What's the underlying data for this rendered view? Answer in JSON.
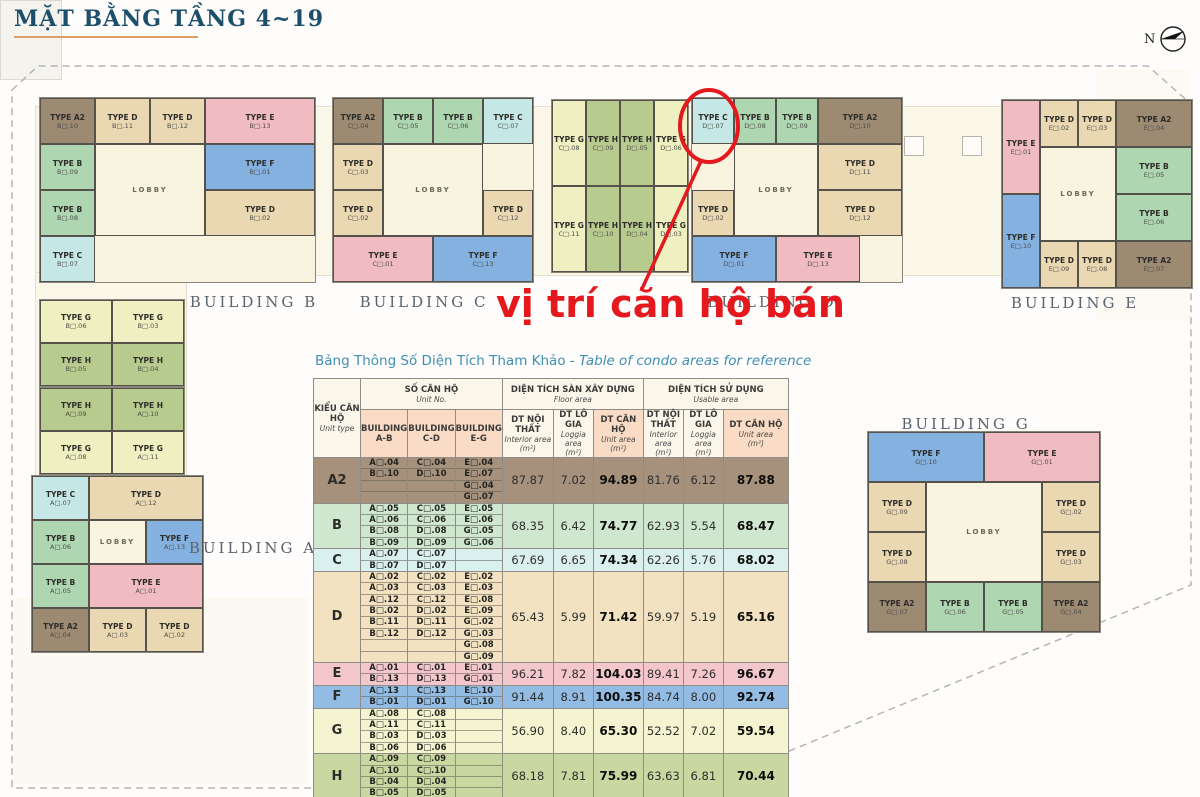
{
  "page": {
    "title": "MẶT BẰNG TẦNG 4~19",
    "north_label": "N",
    "annotation": {
      "text": "vị trí căn hộ bán",
      "color": "#e5191d",
      "highlighted_unit": "TYPE C D□.07"
    }
  },
  "type_colors": {
    "A2": "#9c8a72",
    "B": "#aed6b0",
    "C": "#c5e8e6",
    "D": "#ead8b3",
    "E": "#f0bcc2",
    "F": "#84b1e0",
    "G": "#eff0c2",
    "H": "#b7cb8e",
    "LOBBY": "#f8f4df"
  },
  "plan": {
    "building_labels": [
      "BUILDING B",
      "BUILDING C",
      "BUILDING D",
      "BUILDING E",
      "BUILDING A",
      "BUILDING G"
    ],
    "clusters": [
      {
        "id": "b-main",
        "units": [
          {
            "t": "A2",
            "label": "TYPE A2",
            "no": "B□.10"
          },
          {
            "t": "D",
            "label": "TYPE D",
            "no": "B□.11"
          },
          {
            "t": "D",
            "label": "TYPE D",
            "no": "B□.12"
          },
          {
            "t": "E",
            "label": "TYPE E",
            "no": "B□.13"
          },
          {
            "t": "B",
            "label": "TYPE B",
            "no": "B□.09"
          },
          {
            "t": "LOBBY",
            "label": "LOBBY",
            "no": ""
          },
          {
            "t": "F",
            "label": "TYPE F",
            "no": "B□.01"
          },
          {
            "t": "B",
            "label": "TYPE B",
            "no": "B□.08"
          },
          {
            "t": "D",
            "label": "TYPE D",
            "no": "B□.02"
          },
          {
            "t": "C",
            "label": "TYPE C",
            "no": "B□.07"
          }
        ]
      },
      {
        "id": "c-main",
        "units": [
          {
            "t": "A2",
            "label": "TYPE A2",
            "no": "C□.04"
          },
          {
            "t": "B",
            "label": "TYPE B",
            "no": "C□.05"
          },
          {
            "t": "B",
            "label": "TYPE B",
            "no": "C□.06"
          },
          {
            "t": "C",
            "label": "TYPE C",
            "no": "C□.07"
          },
          {
            "t": "D",
            "label": "TYPE D",
            "no": "C□.03"
          },
          {
            "t": "LOBBY",
            "label": "LOBBY",
            "no": ""
          },
          {
            "t": "D",
            "label": "TYPE D",
            "no": "C□.02"
          },
          {
            "t": "D",
            "label": "TYPE D",
            "no": "C□.12"
          },
          {
            "t": "E",
            "label": "TYPE E",
            "no": "C□.01"
          },
          {
            "t": "F",
            "label": "TYPE F",
            "no": "C□.13"
          }
        ]
      },
      {
        "id": "mid-gh",
        "units": [
          {
            "t": "G",
            "label": "TYPE G",
            "no": "C□.08"
          },
          {
            "t": "H",
            "label": "TYPE H",
            "no": "C□.09"
          },
          {
            "t": "H",
            "label": "TYPE H",
            "no": "D□.05"
          },
          {
            "t": "G",
            "label": "TYPE G",
            "no": "D□.06"
          },
          {
            "t": "G",
            "label": "TYPE G",
            "no": "C□.11"
          },
          {
            "t": "H",
            "label": "TYPE H",
            "no": "C□.10"
          },
          {
            "t": "H",
            "label": "TYPE H",
            "no": "D□.04"
          },
          {
            "t": "G",
            "label": "TYPE G",
            "no": "D□.03"
          }
        ]
      },
      {
        "id": "d-main",
        "units": [
          {
            "t": "C",
            "label": "TYPE C",
            "no": "D□.07"
          },
          {
            "t": "B",
            "label": "TYPE B",
            "no": "D□.08"
          },
          {
            "t": "B",
            "label": "TYPE B",
            "no": "D□.09"
          },
          {
            "t": "A2",
            "label": "TYPE A2",
            "no": "D□.10"
          },
          {
            "t": "LOBBY",
            "label": "LOBBY",
            "no": ""
          },
          {
            "t": "D",
            "label": "TYPE D",
            "no": "D□.11"
          },
          {
            "t": "D",
            "label": "TYPE D",
            "no": "D□.02"
          },
          {
            "t": "D",
            "label": "TYPE D",
            "no": "D□.12"
          },
          {
            "t": "F",
            "label": "TYPE F",
            "no": "D□.01"
          },
          {
            "t": "E",
            "label": "TYPE E",
            "no": "D□.13"
          }
        ]
      },
      {
        "id": "e-main",
        "units": [
          {
            "t": "E",
            "label": "TYPE E",
            "no": "E□.01"
          },
          {
            "t": "D",
            "label": "TYPE D",
            "no": "E□.02"
          },
          {
            "t": "D",
            "label": "TYPE D",
            "no": "E□.03"
          },
          {
            "t": "A2",
            "label": "TYPE A2",
            "no": "E□.04"
          },
          {
            "t": "LOBBY",
            "label": "LOBBY",
            "no": ""
          },
          {
            "t": "B",
            "label": "TYPE B",
            "no": "E□.05"
          },
          {
            "t": "F",
            "label": "TYPE F",
            "no": "E□.10"
          },
          {
            "t": "B",
            "label": "TYPE B",
            "no": "E□.06"
          },
          {
            "t": "D",
            "label": "TYPE D",
            "no": "E□.09"
          },
          {
            "t": "D",
            "label": "TYPE D",
            "no": "E□.08"
          },
          {
            "t": "A2",
            "label": "TYPE A2",
            "no": "E□.07"
          }
        ]
      },
      {
        "id": "b-annex",
        "units": [
          {
            "t": "G",
            "label": "TYPE G",
            "no": "B□.06"
          },
          {
            "t": "G",
            "label": "TYPE G",
            "no": "B□.03"
          },
          {
            "t": "H",
            "label": "TYPE H",
            "no": "B□.05"
          },
          {
            "t": "H",
            "label": "TYPE H",
            "no": "B□.04"
          }
        ]
      },
      {
        "id": "a-annex",
        "units": [
          {
            "t": "H",
            "label": "TYPE H",
            "no": "A□.09"
          },
          {
            "t": "H",
            "label": "TYPE H",
            "no": "A□.10"
          },
          {
            "t": "G",
            "label": "TYPE G",
            "no": "A□.08"
          },
          {
            "t": "G",
            "label": "TYPE G",
            "no": "A□.11"
          }
        ]
      },
      {
        "id": "a-main",
        "units": [
          {
            "t": "C",
            "label": "TYPE C",
            "no": "A□.07"
          },
          {
            "t": "D",
            "label": "TYPE D",
            "no": "A□.12"
          },
          {
            "t": "B",
            "label": "TYPE B",
            "no": "A□.06"
          },
          {
            "t": "LOBBY",
            "label": "LOBBY",
            "no": ""
          },
          {
            "t": "F",
            "label": "TYPE F",
            "no": "A□.13"
          },
          {
            "t": "B",
            "label": "TYPE B",
            "no": "A□.05"
          },
          {
            "t": "E",
            "label": "TYPE E",
            "no": "A□.01"
          },
          {
            "t": "A2",
            "label": "TYPE A2",
            "no": "A□.04"
          },
          {
            "t": "D",
            "label": "TYPE D",
            "no": "A□.03"
          },
          {
            "t": "D",
            "label": "TYPE D",
            "no": "A□.02"
          }
        ]
      },
      {
        "id": "g-main",
        "units": [
          {
            "t": "F",
            "label": "TYPE F",
            "no": "G□.10"
          },
          {
            "t": "E",
            "label": "TYPE E",
            "no": "G□.01"
          },
          {
            "t": "D",
            "label": "TYPE D",
            "no": "G□.09"
          },
          {
            "t": "LOBBY",
            "label": "LOBBY",
            "no": ""
          },
          {
            "t": "D",
            "label": "TYPE D",
            "no": "G□.02"
          },
          {
            "t": "D",
            "label": "TYPE D",
            "no": "G□.08"
          },
          {
            "t": "D",
            "label": "TYPE D",
            "no": "G□.03"
          },
          {
            "t": "A2",
            "label": "TYPE A2",
            "no": "G□.07"
          },
          {
            "t": "B",
            "label": "TYPE B",
            "no": "G□.06"
          },
          {
            "t": "B",
            "label": "TYPE B",
            "no": "G□.05"
          },
          {
            "t": "A2",
            "label": "TYPE A2",
            "no": "G□.04"
          }
        ]
      }
    ]
  },
  "table": {
    "title_vi": "Bảng Thông Số Diện Tích Tham Khảo ",
    "title_en": "- Table of condo areas for reference",
    "header": {
      "unit_type": {
        "vi": "KIỂU CĂN HỘ",
        "en": "Unit type"
      },
      "unit_no": {
        "vi": "SỐ CĂN HỘ",
        "en": "Unit No."
      },
      "floor_group": {
        "vi": "DIỆN TÍCH SÀN XÂY DỰNG",
        "en": "Floor area"
      },
      "usable_group": {
        "vi": "DIỆN TÍCH SỬ DỤNG",
        "en": "Usable area"
      },
      "sub_cols": [
        {
          "vi": "DT NỘI THẤT",
          "en": "Interior area",
          "unit": "(m²)"
        },
        {
          "vi": "DT LÔ GIA",
          "en": "Loggia area",
          "unit": "(m²)"
        },
        {
          "vi": "DT CĂN HỘ",
          "en": "Unit area",
          "unit": "(m²)"
        }
      ],
      "building_cols": [
        "BUILDING A-B",
        "BUILDING C-D",
        "BUILDING E-G"
      ]
    },
    "row_colors": {
      "A2": "#a5917c",
      "B": "#cfe7cf",
      "C": "#daf0ee",
      "D": "#f2e2c1",
      "E": "#f4c7cc",
      "F": "#93bce4",
      "G": "#f4f4d0",
      "H": "#c9d7a1"
    },
    "rows": [
      {
        "type": "A2",
        "ab": [
          "A□.04",
          "B□.10"
        ],
        "cd": [
          "C□.04",
          "D□.10"
        ],
        "eg": [
          "E□.04",
          "E□.07",
          "G□.04",
          "G□.07"
        ],
        "floor": [
          "87.87",
          "7.02",
          "94.89"
        ],
        "usable": [
          "81.76",
          "6.12",
          "87.88"
        ]
      },
      {
        "type": "B",
        "ab": [
          "A□.05",
          "A□.06",
          "B□.08",
          "B□.09"
        ],
        "cd": [
          "C□.05",
          "C□.06",
          "D□.08",
          "D□.09"
        ],
        "eg": [
          "E□.05",
          "E□.06",
          "G□.05",
          "G□.06"
        ],
        "floor": [
          "68.35",
          "6.42",
          "74.77"
        ],
        "usable": [
          "62.93",
          "5.54",
          "68.47"
        ]
      },
      {
        "type": "C",
        "ab": [
          "A□.07",
          "B□.07"
        ],
        "cd": [
          "C□.07",
          "D□.07"
        ],
        "eg": [],
        "floor": [
          "67.69",
          "6.65",
          "74.34"
        ],
        "usable": [
          "62.26",
          "5.76",
          "68.02"
        ]
      },
      {
        "type": "D",
        "ab": [
          "A□.02",
          "A□.03",
          "A□.12",
          "B□.02",
          "B□.11",
          "B□.12"
        ],
        "cd": [
          "C□.02",
          "C□.03",
          "C□.12",
          "D□.02",
          "D□.11",
          "D□.12"
        ],
        "eg": [
          "E□.02",
          "E□.03",
          "E□.08",
          "E□.09",
          "G□.02",
          "G□.03",
          "G□.08",
          "G□.09"
        ],
        "floor": [
          "65.43",
          "5.99",
          "71.42"
        ],
        "usable": [
          "59.97",
          "5.19",
          "65.16"
        ]
      },
      {
        "type": "E",
        "ab": [
          "A□.01",
          "B□.13"
        ],
        "cd": [
          "C□.01",
          "D□.13"
        ],
        "eg": [
          "E□.01",
          "G□.01"
        ],
        "floor": [
          "96.21",
          "7.82",
          "104.03"
        ],
        "usable": [
          "89.41",
          "7.26",
          "96.67"
        ]
      },
      {
        "type": "F",
        "ab": [
          "A□.13",
          "B□.01"
        ],
        "cd": [
          "C□.13",
          "D□.01"
        ],
        "eg": [
          "E□.10",
          "G□.10"
        ],
        "floor": [
          "91.44",
          "8.91",
          "100.35"
        ],
        "usable": [
          "84.74",
          "8.00",
          "92.74"
        ]
      },
      {
        "type": "G",
        "ab": [
          "A□.08",
          "A□.11",
          "B□.03",
          "B□.06"
        ],
        "cd": [
          "C□.08",
          "C□.11",
          "D□.03",
          "D□.06"
        ],
        "eg": [],
        "floor": [
          "56.90",
          "8.40",
          "65.30"
        ],
        "usable": [
          "52.52",
          "7.02",
          "59.54"
        ]
      },
      {
        "type": "H",
        "ab": [
          "A□.09",
          "A□.10",
          "B□.04",
          "B□.05"
        ],
        "cd": [
          "C□.09",
          "C□.10",
          "D□.04",
          "D□.05"
        ],
        "eg": [],
        "floor": [
          "68.18",
          "7.81",
          "75.99"
        ],
        "usable": [
          "63.63",
          "6.81",
          "70.44"
        ]
      }
    ]
  }
}
